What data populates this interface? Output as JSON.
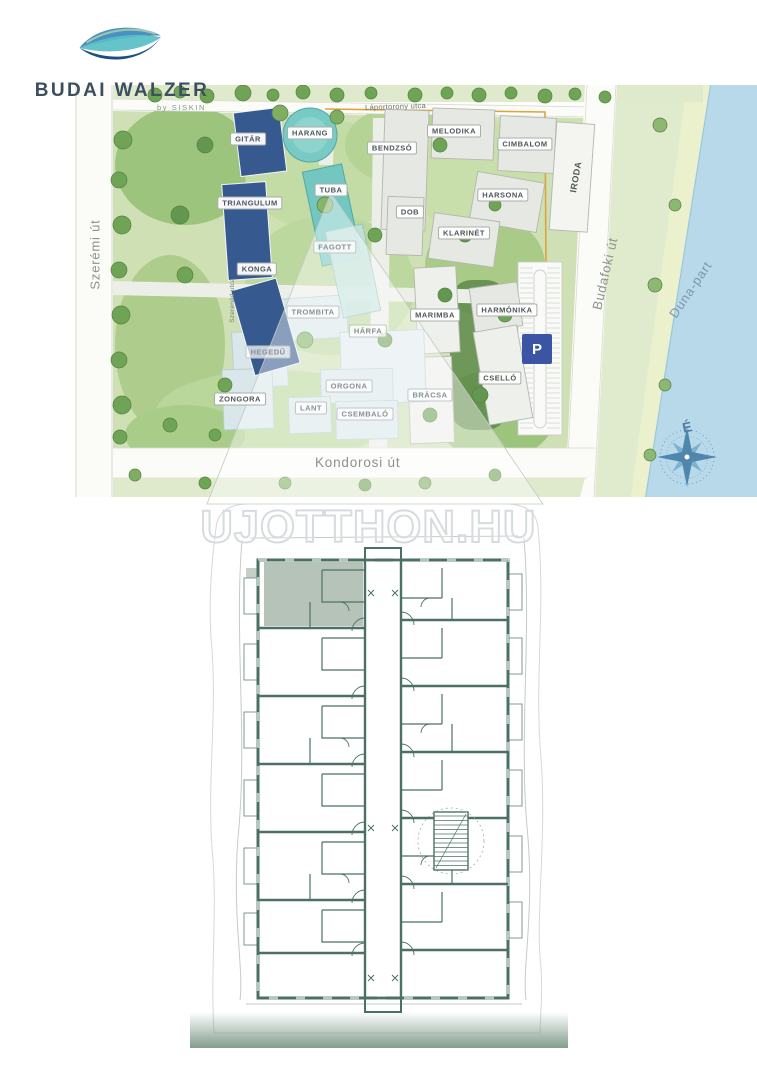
{
  "brand": {
    "title": "BUDAI WALZER",
    "byline": "by SISKIN"
  },
  "site_plan": {
    "streets": {
      "top": "Láportorony utca",
      "left": "Szerémi út",
      "inner": "Szerenád utca",
      "right": "Budafoki út",
      "bottom": "Kondorosi út",
      "riverside": "Duna-part"
    },
    "compass_north_label": "É",
    "parking_badge": "P",
    "buildings": [
      {
        "label": "GITÁR"
      },
      {
        "label": "HARANG"
      },
      {
        "label": "TUBA"
      },
      {
        "label": "TRIANGULUM"
      },
      {
        "label": "KONGA"
      },
      {
        "label": "FAGOTT"
      },
      {
        "label": "BENDZSÓ"
      },
      {
        "label": "MELODIKA"
      },
      {
        "label": "CIMBALOM"
      },
      {
        "label": "DOB"
      },
      {
        "label": "HARSONA"
      },
      {
        "label": "KLARINÉT"
      },
      {
        "label": "IRODA"
      },
      {
        "label": "TROMBITA"
      },
      {
        "label": "HÁRFA"
      },
      {
        "label": "MARIMBA"
      },
      {
        "label": "HARMÓNIKA"
      },
      {
        "label": "HEGEDŰ"
      },
      {
        "label": "ZONGORA"
      },
      {
        "label": "ORGONA"
      },
      {
        "label": "LANT"
      },
      {
        "label": "CSEMBALÓ"
      },
      {
        "label": "BRÁCSA"
      },
      {
        "label": "CSELLÓ"
      }
    ]
  },
  "floor_plan": {
    "watermark": "UJOTTHON.HU"
  },
  "colors": {
    "brand_navy": "#1c4f80",
    "brand_blue": "#4a90c0",
    "brand_teal": "#58bfc6",
    "highlight_building_blue": "#36598f",
    "teal_building": "#74c7c1",
    "water": "#b7d9ea",
    "parking_blue": "#3b54a4",
    "plan_wall_green": "#4b7164",
    "site_boundary_orange": "#dca33e"
  }
}
